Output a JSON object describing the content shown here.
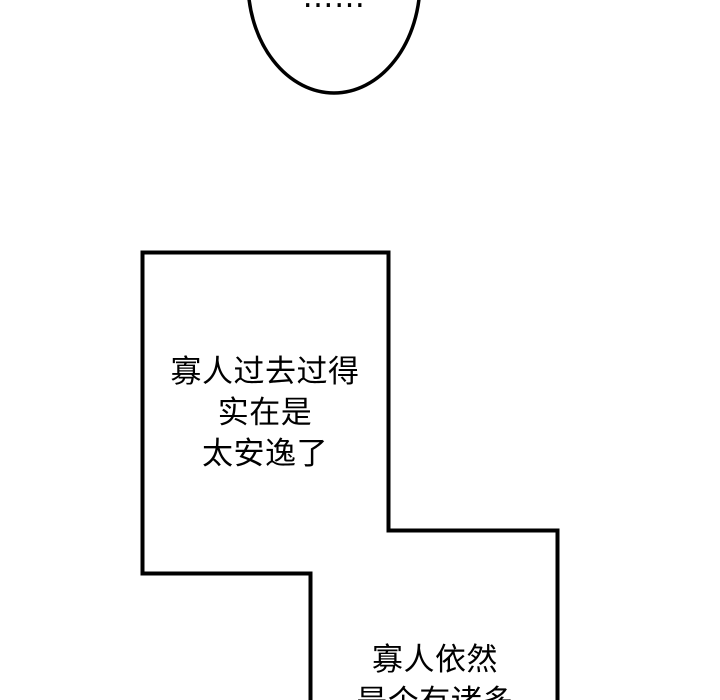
{
  "panel": {
    "background_color": "#ffffff",
    "ink_color": "#000000"
  },
  "speech_bubbles": {
    "ellipsis_bubble": {
      "text": "……"
    },
    "past_bubble": {
      "lines": [
        "寡人过去过得",
        "实在是",
        "太安逸了"
      ]
    },
    "still_bubble": {
      "lines": [
        "寡人依然",
        "是个有诸多"
      ]
    }
  }
}
